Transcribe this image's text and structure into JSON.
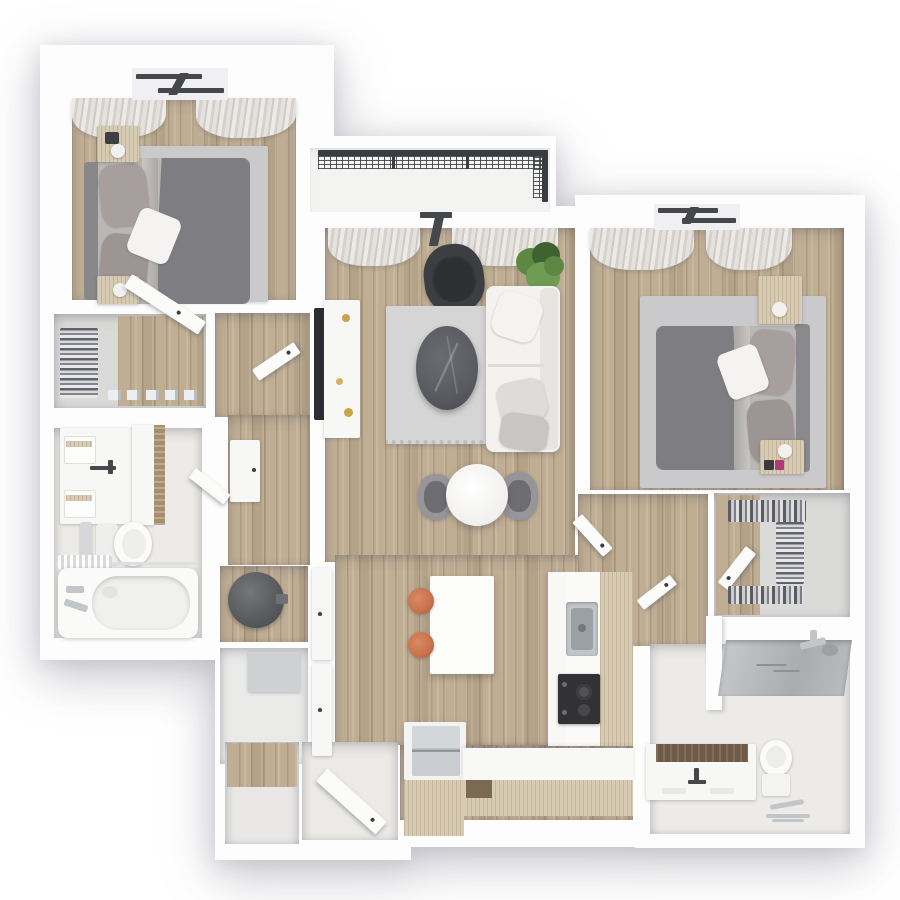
{
  "meta": {
    "kind": "3d-rendered-floor-plan",
    "view": "top-down isometric",
    "unit_type": "2 bedroom / 2 bathroom apartment with balcony",
    "visible_text": ""
  },
  "palette": {
    "wall": "#fdfdfd",
    "floor_wood": "#bfae94",
    "cabinet_wood": "#d7ccb3",
    "tile": "#edebe7",
    "closet_gray": "#dadad8",
    "rug": "#cac9cb",
    "rug_living": "#d5d5d6",
    "bedding_dark": "#7e7d81",
    "bedding_light": "#bab7b4",
    "pillow_mauve": "#a79e9e",
    "pillow_white": "#f4f3f1",
    "frame_dark": "#46474a",
    "railing": "#3a3d40",
    "chair_dark": "#3d3e42",
    "plant_green": "#5d8743",
    "plant_green_dark": "#3f6330",
    "sofa_white": "#f3f2ef",
    "marble_dark": "#595b60",
    "steel": "#c3c6c9",
    "steel_dark": "#9aa0a4",
    "stool_orange": "#c9714b",
    "vanity_top_brown": "#6d5a47",
    "heater_gray": "#595b5e"
  },
  "rooms": [
    {
      "id": "bedroom-1",
      "position": "top-left",
      "furniture": [
        "double-bed",
        "headboard",
        "area-rug",
        "nightstand",
        "nightstand",
        "curtains",
        "window"
      ]
    },
    {
      "id": "walk-in-closet-1",
      "position": "left",
      "furniture": [
        "shelving-with-folded-clothes",
        "closet-door"
      ]
    },
    {
      "id": "bathroom-1",
      "position": "left",
      "furniture": [
        "double-vanity",
        "tall-cabinet",
        "toilet",
        "bathtub",
        "shower-rod",
        "towel-bar"
      ]
    },
    {
      "id": "utility-closet",
      "position": "center-left",
      "furniture": [
        "water-heater",
        "utility-box",
        "closet-doors"
      ]
    },
    {
      "id": "balcony",
      "position": "top-center",
      "furniture": [
        "metal-mesh-railing"
      ]
    },
    {
      "id": "living-room",
      "position": "center",
      "furniture": [
        "sofa",
        "accent-armchair",
        "oval-coffee-table",
        "area-rug",
        "tv-console",
        "tv",
        "plant",
        "curtains",
        "window"
      ]
    },
    {
      "id": "dining-area",
      "position": "center",
      "furniture": [
        "round-table",
        "chair",
        "chair"
      ]
    },
    {
      "id": "kitchen",
      "position": "center-bottom",
      "furniture": [
        "island",
        "bar-stool",
        "bar-stool",
        "sink",
        "cooktop",
        "refrigerator",
        "l-shaped-counter"
      ]
    },
    {
      "id": "entry",
      "position": "bottom",
      "furniture": [
        "entry-door",
        "coat-closet"
      ]
    },
    {
      "id": "bedroom-2",
      "position": "right",
      "furniture": [
        "double-bed",
        "headboard",
        "area-rug",
        "nightstand",
        "nightstand",
        "curtains",
        "window"
      ]
    },
    {
      "id": "walk-in-closet-2",
      "position": "right",
      "furniture": [
        "hanging-clothes",
        "shelving-with-folded-clothes",
        "closet-door"
      ]
    },
    {
      "id": "bathroom-2",
      "position": "bottom-right",
      "furniture": [
        "walk-in-shower",
        "vanity",
        "toilet",
        "towel-stand",
        "door"
      ]
    }
  ]
}
